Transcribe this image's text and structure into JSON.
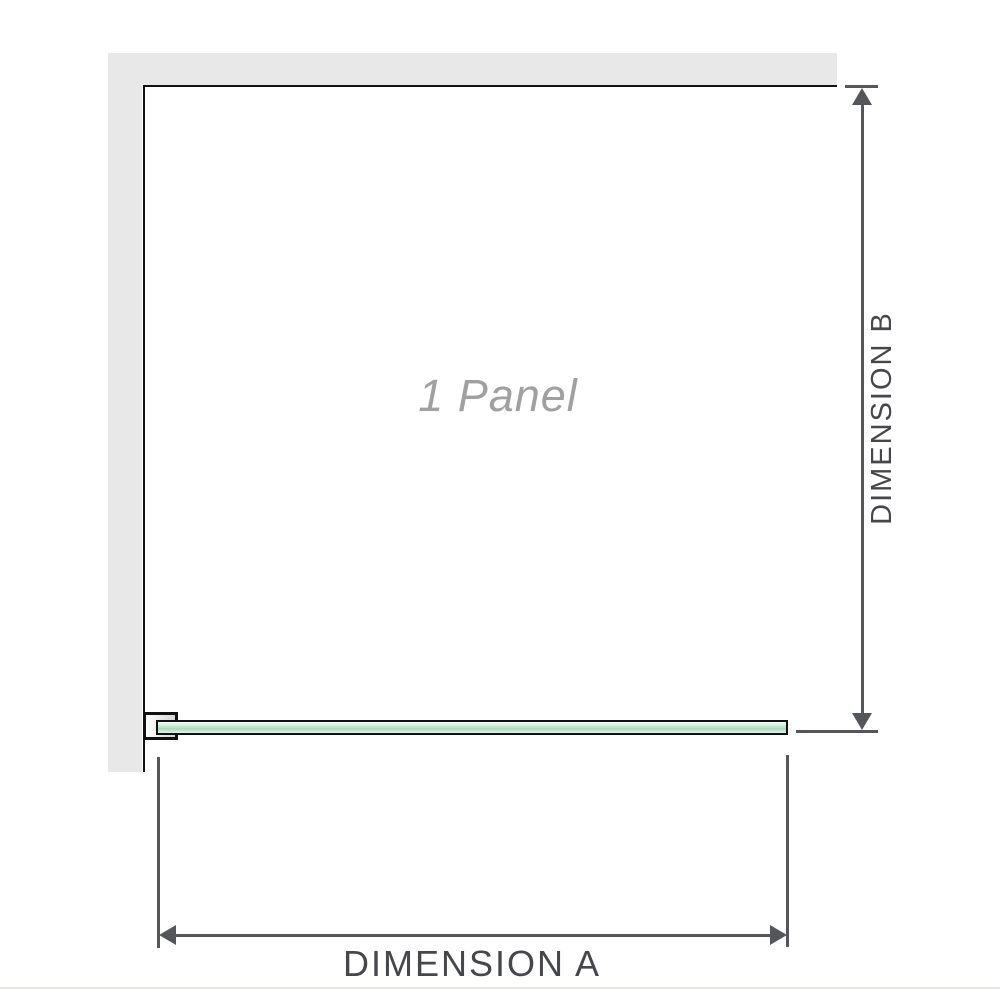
{
  "diagram": {
    "panel_label": "1 Panel",
    "dimensions": {
      "a": {
        "label": "DIMENSION A",
        "orientation": "horizontal"
      },
      "b": {
        "label": "DIMENSION B",
        "orientation": "vertical"
      }
    },
    "elements": {
      "wall": "l-shaped-wall",
      "glass_panel": "single-glass-panel",
      "bracket": "wall-mount-bracket"
    }
  },
  "colors": {
    "wall": "#e8e8e8",
    "outline": "#111111",
    "dimension_line": "#55565a",
    "dimension_text": "#45474b",
    "panel_label_text": "#a0a0a0",
    "glass_green_light": "#ddf0e3",
    "glass_green_mid": "#a6dab8",
    "bracket_fill": "#d6d6d6",
    "bottom_border": "#e9e7e2"
  }
}
